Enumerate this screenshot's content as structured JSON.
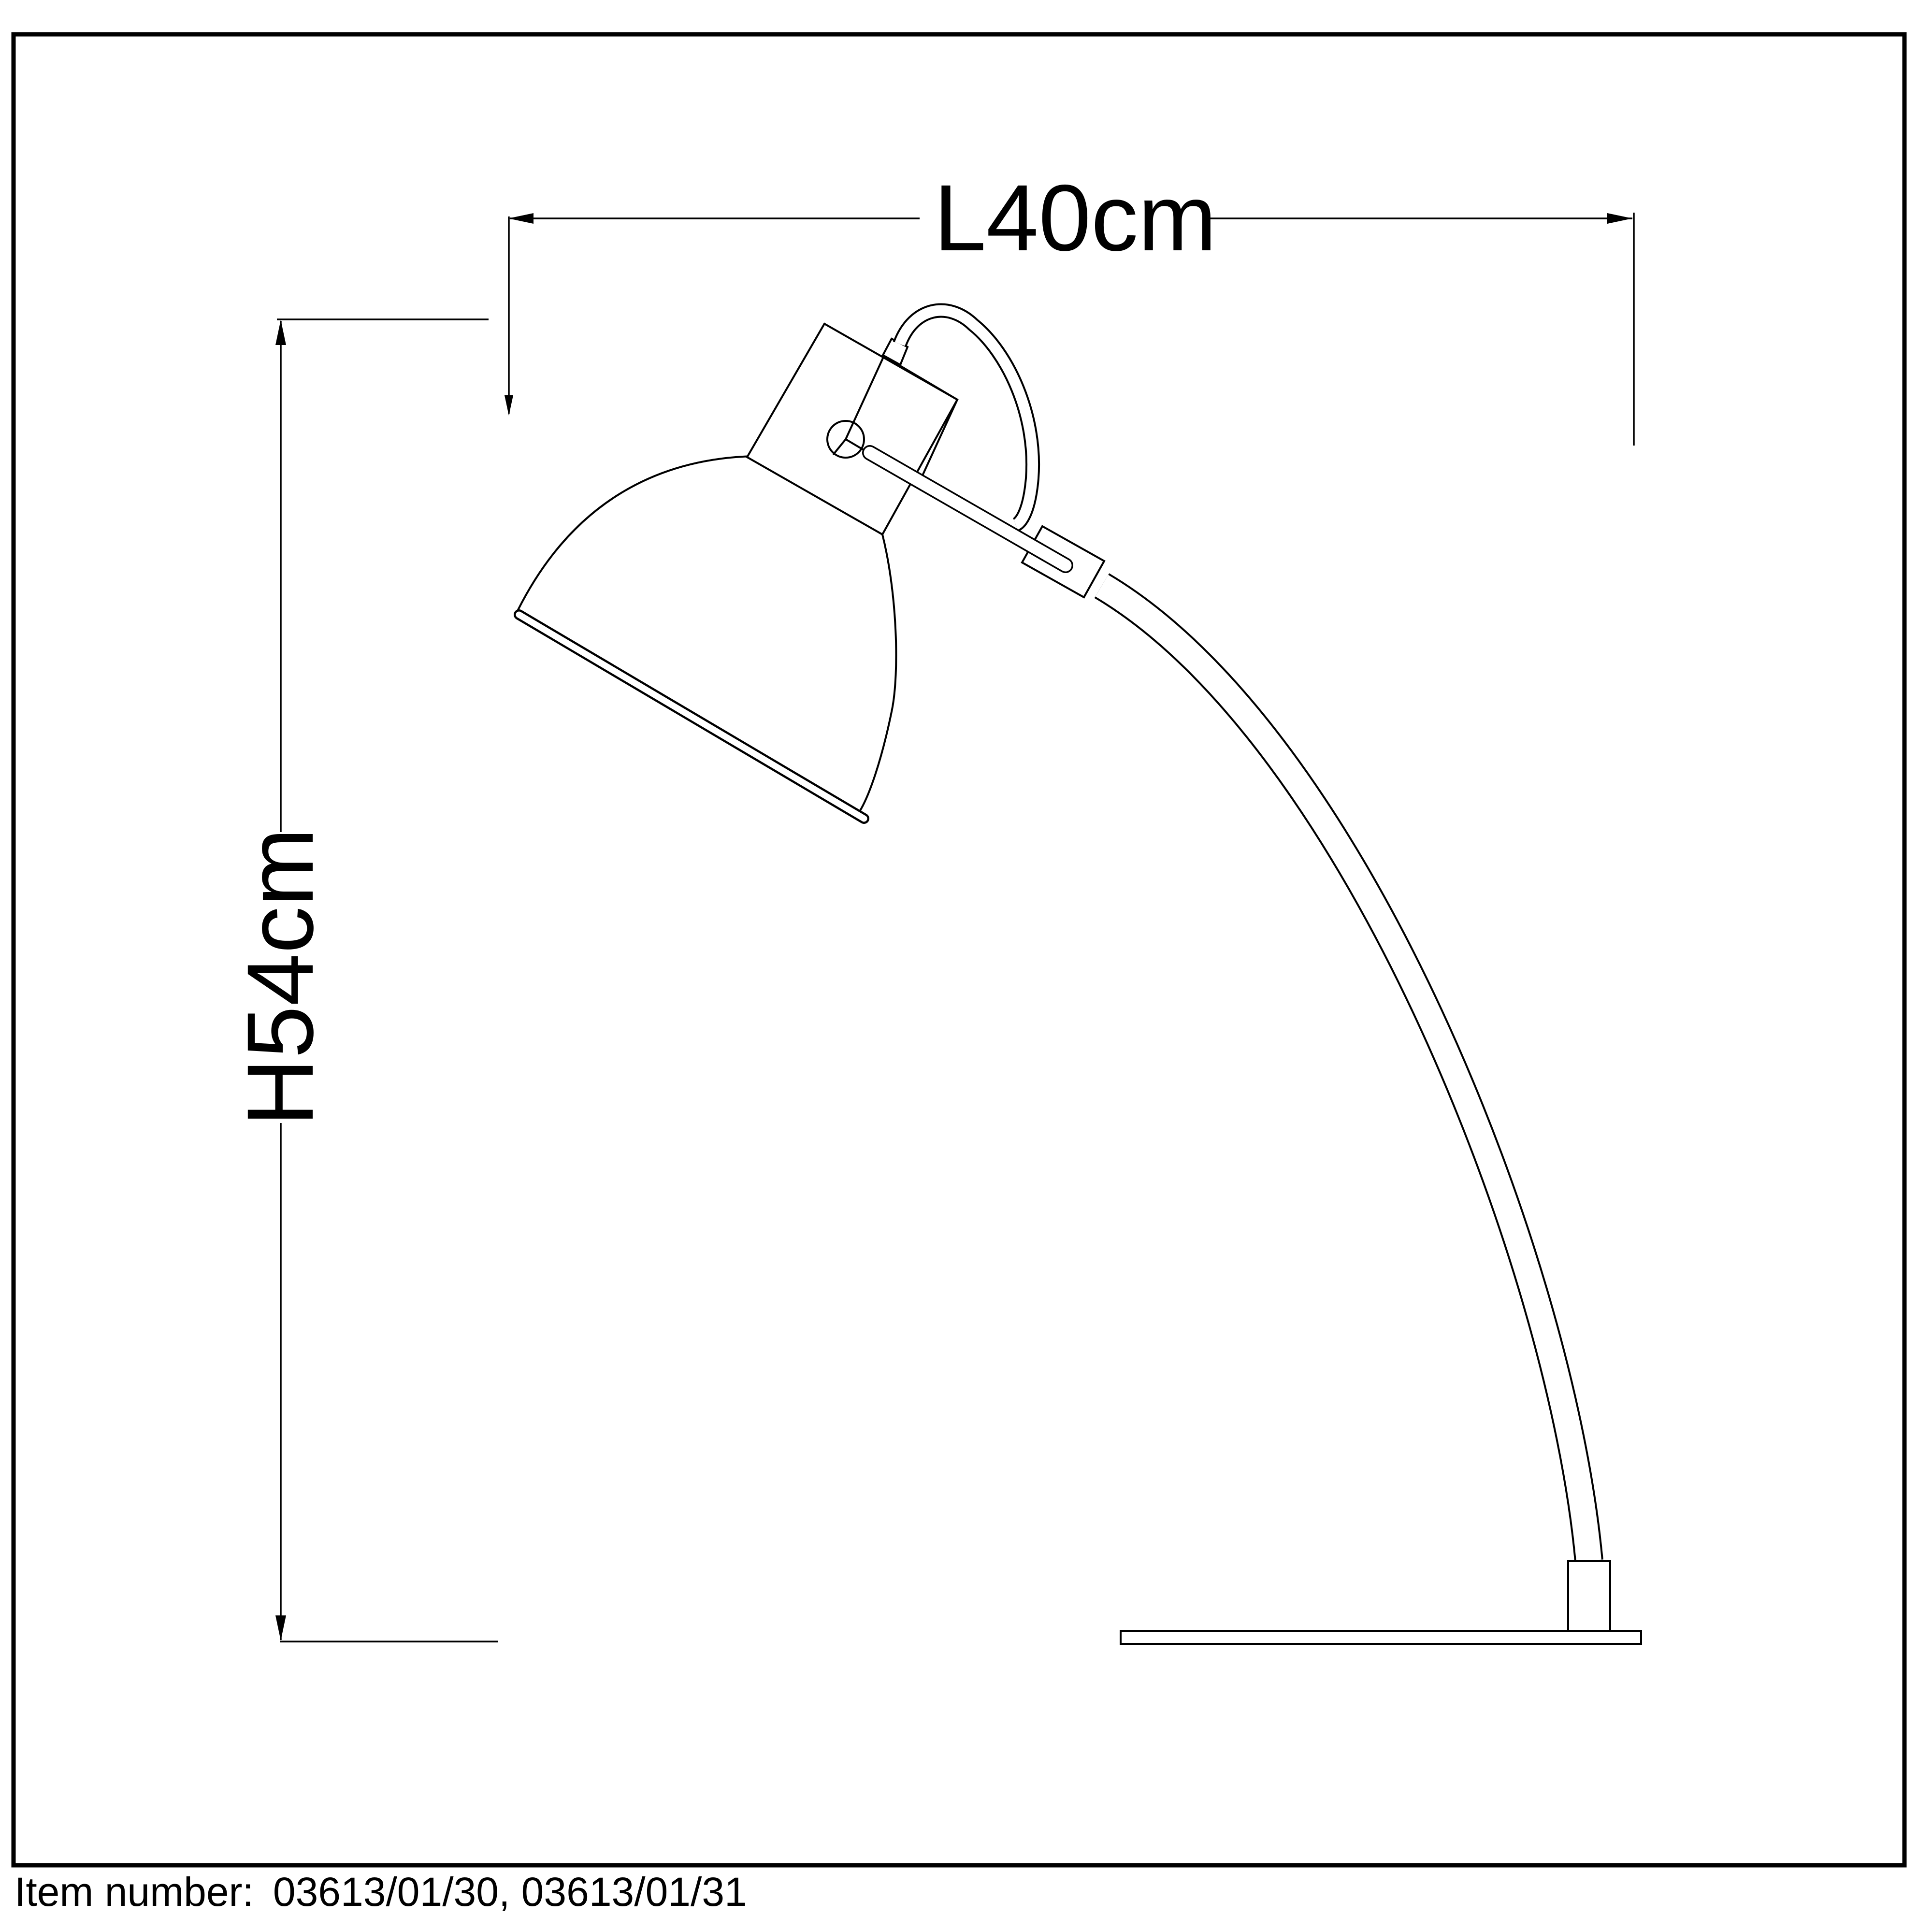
{
  "diagram": {
    "type": "product-dimension-drawing",
    "background_color": "#ffffff",
    "line_color": "#000000",
    "subject": "arc desk lamp line drawing",
    "dimensions": {
      "length_label": "L40cm",
      "height_label": "H54cm"
    }
  },
  "footer": {
    "item_number_label": "Item number:",
    "item_numbers": "03613/01/30, 03613/01/31"
  }
}
